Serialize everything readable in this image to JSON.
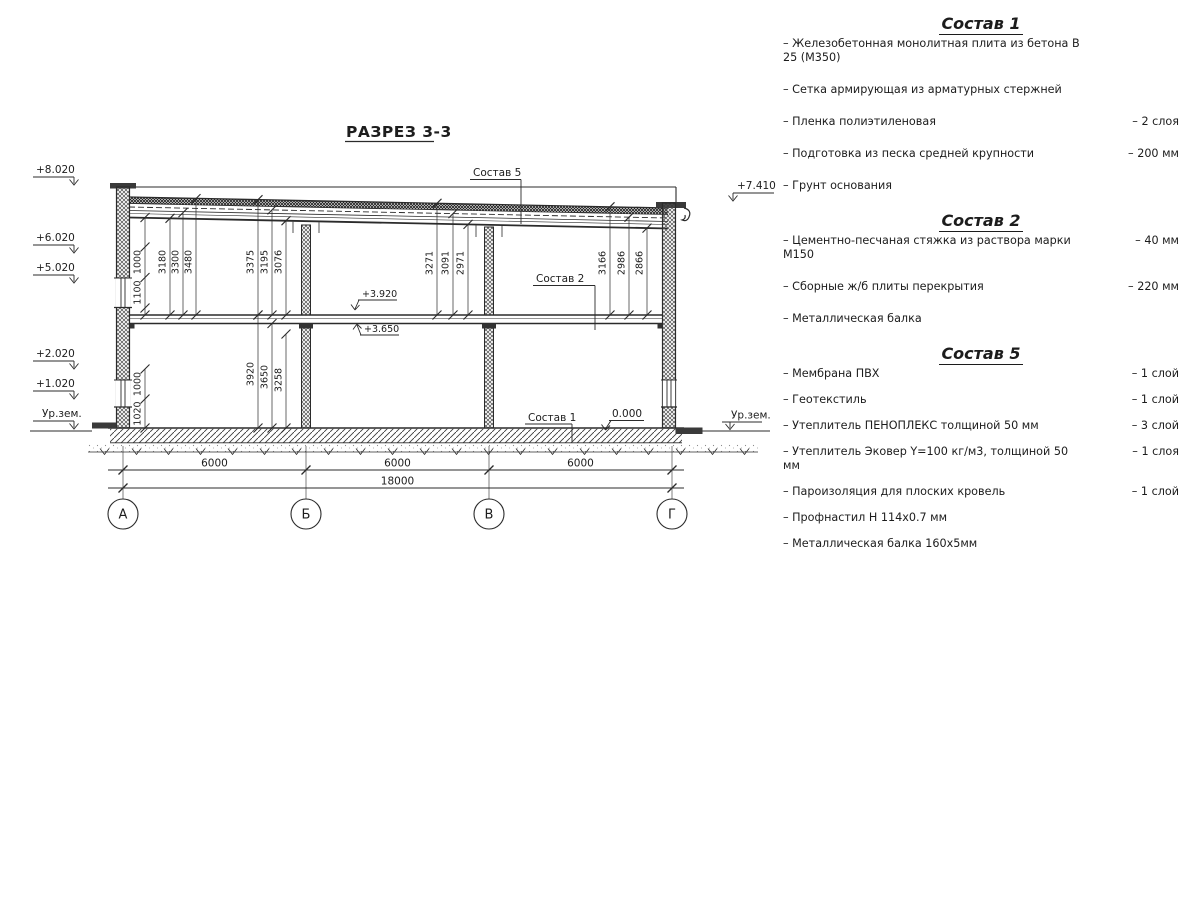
{
  "title": "РАЗРЕЗ 3-3",
  "drawing": {
    "axes": [
      "А",
      "Б",
      "В",
      "Г"
    ],
    "elevations": {
      "left": [
        "+8.020",
        "+6.020",
        "+5.020",
        "+2.020",
        "+1.020",
        "Ур.зем."
      ],
      "right_top": "+7.410",
      "right_ground": "Ур.зем.",
      "slab_top": "+3.920",
      "slab_bottom": "+3.650",
      "zero": "0.000"
    },
    "leaders": {
      "s5": "Состав 5",
      "s2": "Состав 2",
      "s1": "Состав 1"
    },
    "dims": {
      "wall_upper": [
        "1000",
        "1100"
      ],
      "bay1_upper": [
        "3180",
        "3300",
        "3480"
      ],
      "b_upper": [
        "3375",
        "3195",
        "3076"
      ],
      "v_upper": [
        "3271",
        "3091",
        "2971"
      ],
      "g_upper": [
        "3166",
        "2986",
        "2866"
      ],
      "wall_lower": [
        "1000",
        "1020"
      ],
      "b_lower": [
        "3920",
        "3650",
        "3258"
      ],
      "spans": [
        "6000",
        "6000",
        "6000"
      ],
      "total": "18000"
    }
  },
  "panel": {
    "sections": [
      {
        "heading": "Состав 1",
        "items": [
          {
            "text": "– Железобетонная монолитная плита из бетона В 25 (М350)",
            "value": ""
          },
          {
            "text": "– Сетка армирующая из арматурных стержней",
            "value": ""
          },
          {
            "text": "– Пленка полиэтиленовая",
            "value": "– 2 слоя"
          },
          {
            "text": "– Подготовка из песка средней крупности",
            "value": "– 200 мм"
          },
          {
            "text": "– Грунт основания",
            "value": ""
          }
        ]
      },
      {
        "heading": "Состав 2",
        "items": [
          {
            "text": "– Цементно-песчаная стяжка из раствора марки М150",
            "value": "– 40 мм"
          },
          {
            "text": "– Сборные ж/б плиты перекрытия",
            "value": "– 220 мм"
          },
          {
            "text": "– Металлическая балка",
            "value": ""
          }
        ]
      },
      {
        "heading": "Состав 5",
        "items": [
          {
            "text": "– Мембрана ПВХ",
            "value": "– 1 слой"
          },
          {
            "text": "– Геотекстиль",
            "value": "– 1 слой"
          },
          {
            "text": "– Утеплитель ПЕНОПЛЕКС толщиной 50 мм",
            "value": "– 3 слой"
          },
          {
            "text": "– Утеплитель Эковер Y=100 кг/м3, толщиной 50 мм",
            "value": "– 1 слоя"
          },
          {
            "text": "– Пароизоляция для плоских кровель",
            "value": "– 1 слой"
          },
          {
            "text": "– Профнастил Н 114х0.7 мм",
            "value": ""
          },
          {
            "text": "– Металлическая балка 160х5мм",
            "value": ""
          }
        ]
      }
    ]
  }
}
